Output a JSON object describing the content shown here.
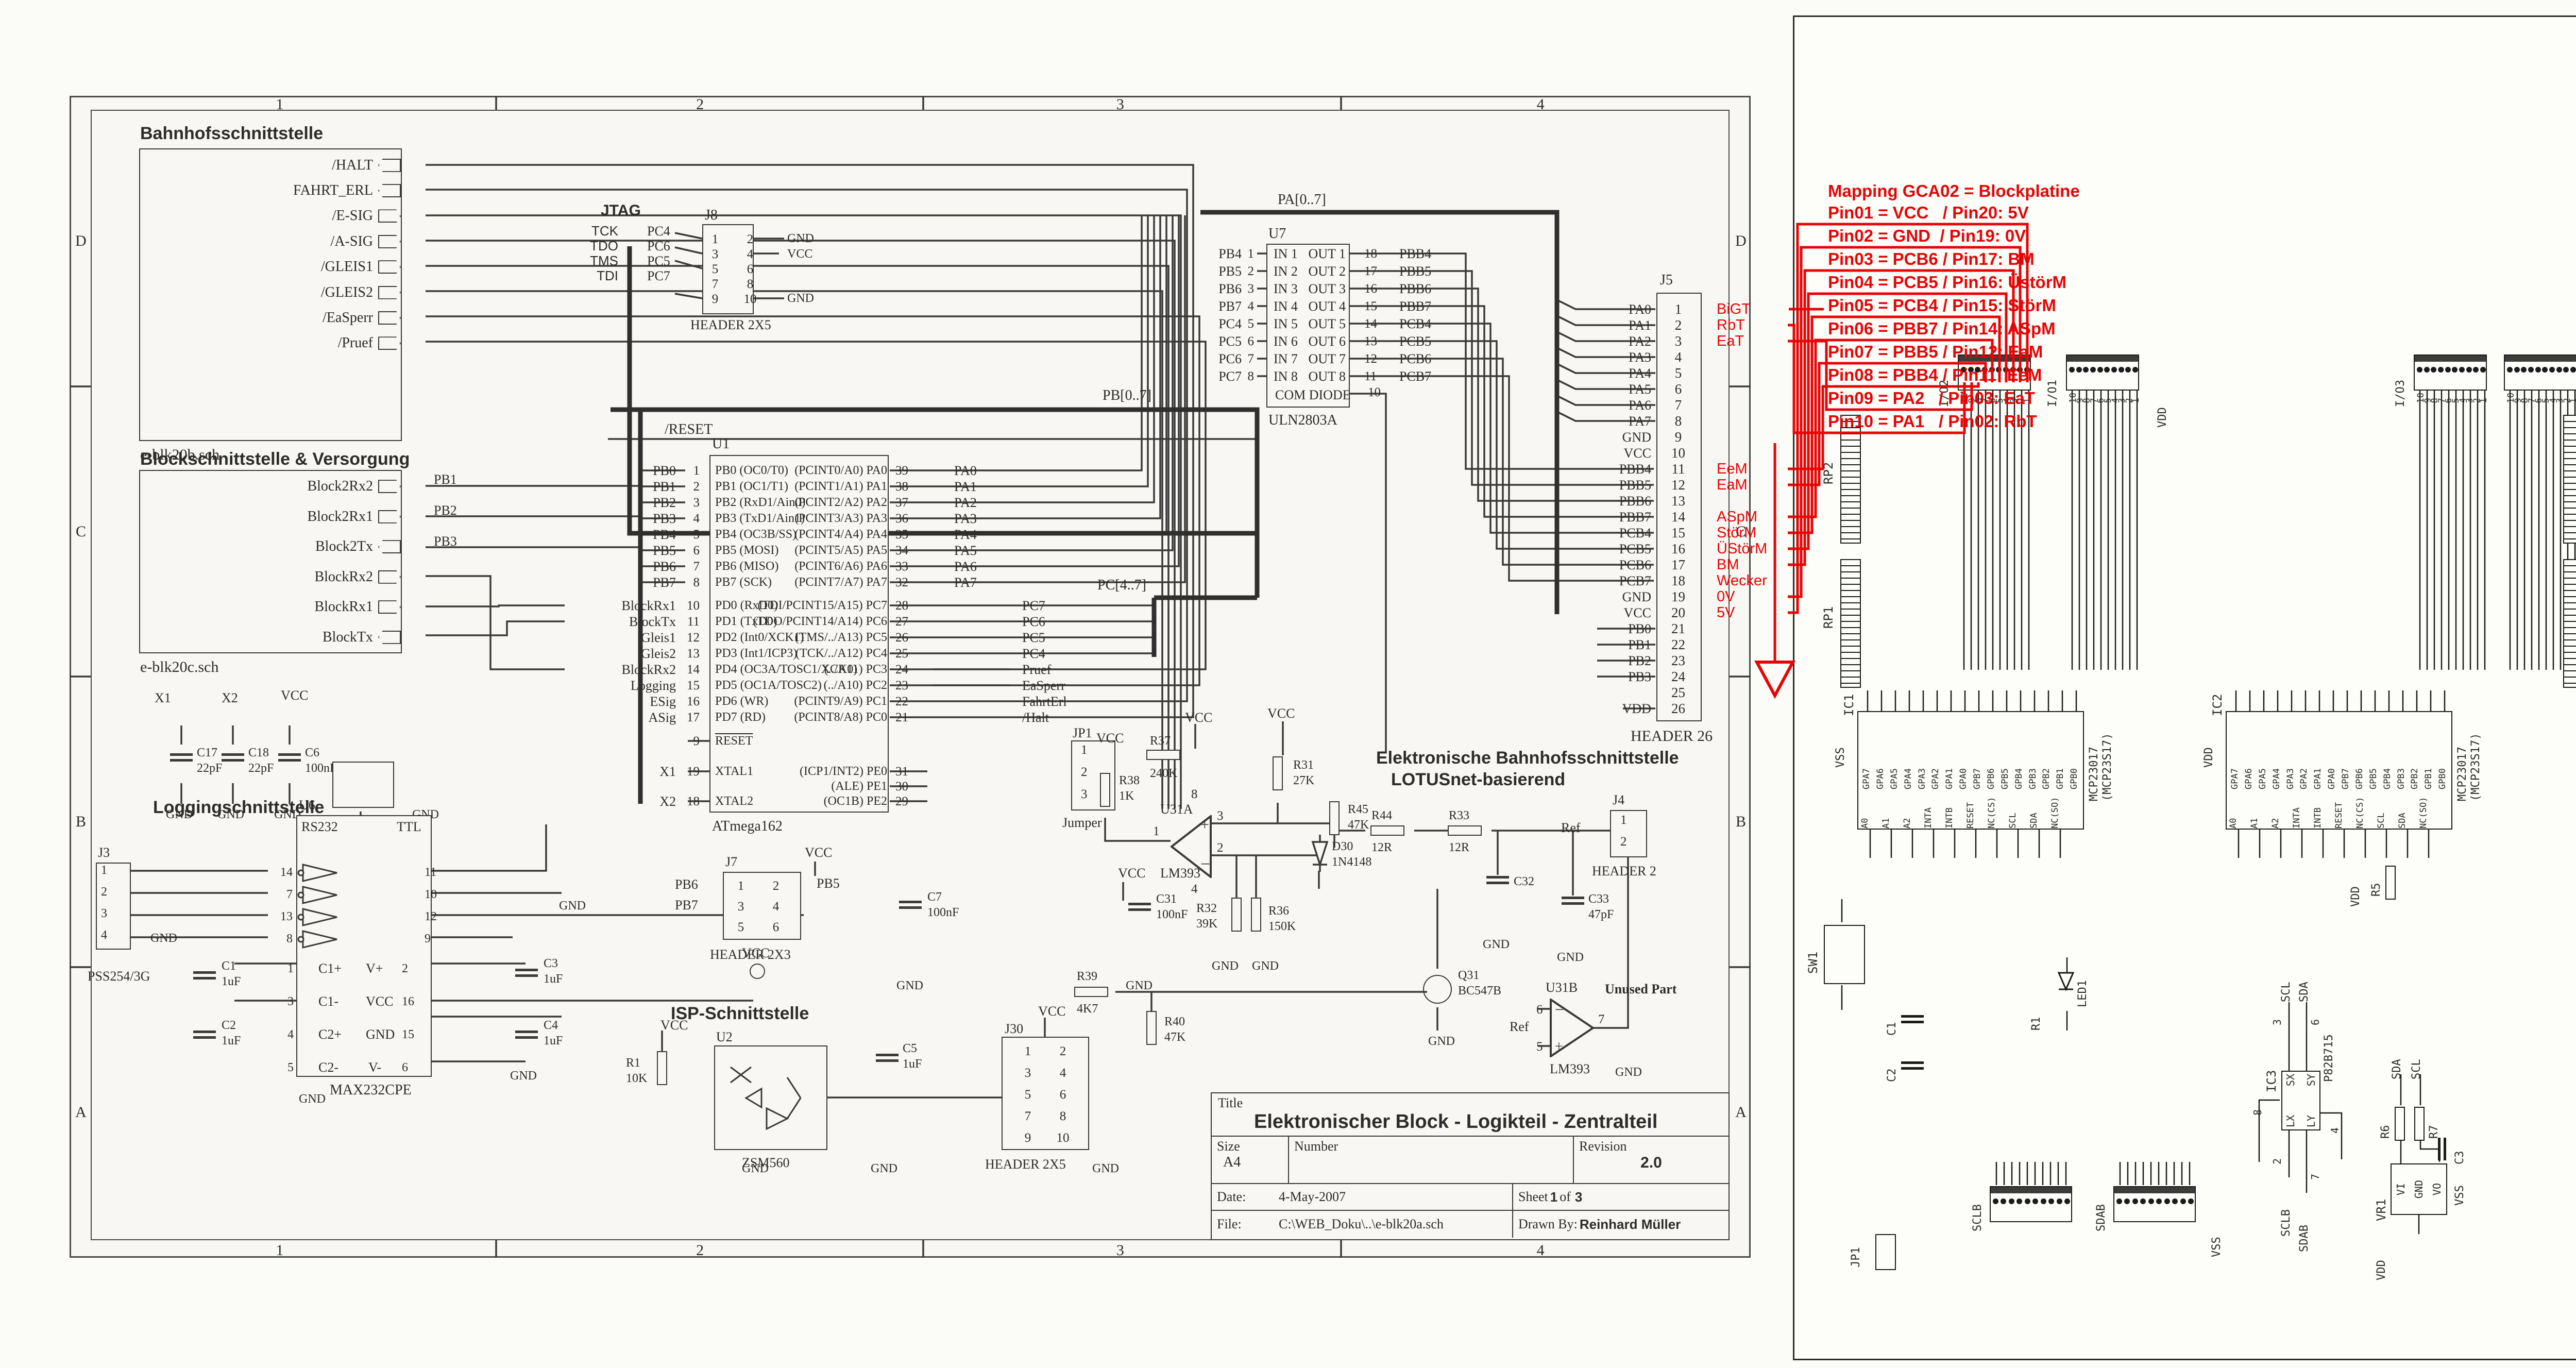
{
  "nets": {
    "gnd": "GND",
    "vcc": "VCC",
    "vdd": "VDD",
    "vss": "VSS",
    "sda": "SDA",
    "scl": "SCL",
    "sclb": "SCLB",
    "sdab": "SDAB",
    "reset": "/RESET",
    "pa_bus": "PA[0..7]",
    "pb_bus": "PB[0..7]",
    "pc_bus": "PC[4..7]",
    "x1": "X1",
    "x2": "X2",
    "ref": "Ref"
  },
  "left": {
    "ruler": {
      "cols": [
        "1",
        "2",
        "3",
        "4"
      ],
      "rows": [
        "D",
        "C",
        "B",
        "A"
      ]
    },
    "bahnhof": {
      "title": "Bahnhofsschnittstelle",
      "file": "e-blk20b.sch",
      "pins": [
        {
          "label": "/HALT",
          "dir": "in"
        },
        {
          "label": "FAHRT_ERL",
          "dir": "in"
        },
        {
          "label": "/E-SIG",
          "dir": "out"
        },
        {
          "label": "/A-SIG",
          "dir": "out"
        },
        {
          "label": "/GLEIS1",
          "dir": "out"
        },
        {
          "label": "/GLEIS2",
          "dir": "out"
        },
        {
          "label": "/EaSperr",
          "dir": "out"
        },
        {
          "label": "/Pruef",
          "dir": "out"
        }
      ]
    },
    "block2": {
      "title": "Blockschnittstelle & Versorgung",
      "file": "e-blk20c.sch",
      "pins": [
        {
          "label": "Block2Rx2",
          "dir": "out"
        },
        {
          "label": "Block2Rx1",
          "dir": "out"
        },
        {
          "label": "Block2Tx",
          "dir": "in"
        },
        {
          "label": "BlockRx2",
          "dir": "out"
        },
        {
          "label": "BlockRx1",
          "dir": "out"
        },
        {
          "label": "BlockTx",
          "dir": "in"
        }
      ],
      "right_nets": [
        "PB1",
        "PB2",
        "PB3"
      ]
    },
    "jtag": {
      "title": "JTAG",
      "rows": [
        {
          "sig": "TCK",
          "net": "PC4"
        },
        {
          "sig": "TDO",
          "net": "PC6"
        },
        {
          "sig": "TMS",
          "net": "PC5"
        },
        {
          "sig": "TDI",
          "net": "PC7"
        }
      ],
      "ref": "J8",
      "part": "HEADER 2X5",
      "pins": [
        {
          "l": "1",
          "r": "2"
        },
        {
          "l": "3",
          "r": "4"
        },
        {
          "l": "5",
          "r": "6"
        },
        {
          "l": "7",
          "r": "8"
        },
        {
          "l": "9",
          "r": "10"
        }
      ]
    },
    "u1": {
      "ref": "U1",
      "part": "ATmega162",
      "left_pb": [
        {
          "sig": "PB0",
          "pin": "1",
          "fn": "PB0 (OC0/T0)"
        },
        {
          "sig": "PB1",
          "pin": "2",
          "fn": "PB1 (OC1/T1)"
        },
        {
          "sig": "PB2",
          "pin": "3",
          "fn": "PB2 (RxD1/Ain0)"
        },
        {
          "sig": "PB3",
          "pin": "4",
          "fn": "PB3 (TxD1/Ain1)"
        },
        {
          "sig": "PB4",
          "pin": "5",
          "fn": "PB4 (OC3B/SS)"
        },
        {
          "sig": "PB5",
          "pin": "6",
          "fn": "PB5 (MOSI)"
        },
        {
          "sig": "PB6",
          "pin": "7",
          "fn": "PB6 (MISO)"
        },
        {
          "sig": "PB7",
          "pin": "8",
          "fn": "PB7 (SCK)"
        }
      ],
      "left_pd": [
        {
          "sig": "BlockRx1",
          "pin": "10",
          "fn": "PD0 (RxD0)"
        },
        {
          "sig": "BlockTx",
          "pin": "11",
          "fn": "PD1 (TxD0)"
        },
        {
          "sig": "Gleis1",
          "pin": "12",
          "fn": "PD2 (Int0/XCK1)"
        },
        {
          "sig": "Gleis2",
          "pin": "13",
          "fn": "PD3 (Int1/ICP3)"
        },
        {
          "sig": "BlockRx2",
          "pin": "14",
          "fn": "PD4 (OC3A/TOSC1/XCK0)"
        },
        {
          "sig": "Logging",
          "pin": "15",
          "fn": "PD5 (OC1A/TOSC2)"
        },
        {
          "sig": "ESig",
          "pin": "16",
          "fn": "PD6 (WR)"
        },
        {
          "sig": "ASig",
          "pin": "17",
          "fn": "PD7 (RD)"
        }
      ],
      "left_misc": [
        {
          "sig": "",
          "pin": "9",
          "fn": "RESET"
        },
        {
          "sig": "X1",
          "pin": "19",
          "fn": "XTAL1"
        },
        {
          "sig": "X2",
          "pin": "18",
          "fn": "XTAL2"
        }
      ],
      "right_pa": [
        {
          "fn": "(PCINT0/A0) PA0",
          "pin": "39",
          "sig": "PA0"
        },
        {
          "fn": "(PCINT1/A1) PA1",
          "pin": "38",
          "sig": "PA1"
        },
        {
          "fn": "(PCINT2/A2) PA2",
          "pin": "37",
          "sig": "PA2"
        },
        {
          "fn": "(PCINT3/A3) PA3",
          "pin": "36",
          "sig": "PA3"
        },
        {
          "fn": "(PCINT4/A4) PA4",
          "pin": "35",
          "sig": "PA4"
        },
        {
          "fn": "(PCINT5/A5) PA5",
          "pin": "34",
          "sig": "PA5"
        },
        {
          "fn": "(PCINT6/A6) PA6",
          "pin": "33",
          "sig": "PA6"
        },
        {
          "fn": "(PCINT7/A7) PA7",
          "pin": "32",
          "sig": "PA7"
        }
      ],
      "right_pc": [
        {
          "fn": "(TDI/PCINT15/A15) PC7",
          "pin": "28",
          "sig": "PC7"
        },
        {
          "fn": "(TDO/PCINT14/A14) PC6",
          "pin": "27",
          "sig": "PC6"
        },
        {
          "fn": "(TMS/../A13) PC5",
          "pin": "26",
          "sig": "PC5"
        },
        {
          "fn": "(TCK/../A12) PC4",
          "pin": "25",
          "sig": "PC4"
        },
        {
          "fn": "(../A11) PC3",
          "pin": "24",
          "sig": "Pruef"
        },
        {
          "fn": "(../A10) PC2",
          "pin": "23",
          "sig": "EaSperr"
        },
        {
          "fn": "(PCINT9/A9) PC1",
          "pin": "22",
          "sig": "FahrtErl"
        },
        {
          "fn": "(PCINT8/A8) PC0",
          "pin": "21",
          "sig": "/Halt"
        }
      ],
      "right_pe": [
        {
          "fn": "(ICP1/INT2) PE0",
          "pin": "31",
          "sig": ""
        },
        {
          "fn": "(ALE) PE1",
          "pin": "30",
          "sig": ""
        },
        {
          "fn": "(OC1B) PE2",
          "pin": "29",
          "sig": ""
        }
      ]
    },
    "u7": {
      "ref": "U7",
      "part": "ULN2803A",
      "com": "COM DIODE",
      "com_pin": "10",
      "left": [
        {
          "sig": "PB4",
          "pin": "1",
          "fn": "IN 1"
        },
        {
          "sig": "PB5",
          "pin": "2",
          "fn": "IN 2"
        },
        {
          "sig": "PB6",
          "pin": "3",
          "fn": "IN 3"
        },
        {
          "sig": "PB7",
          "pin": "4",
          "fn": "IN 4"
        },
        {
          "sig": "PC4",
          "pin": "5",
          "fn": "IN 5"
        },
        {
          "sig": "PC5",
          "pin": "6",
          "fn": "IN 6"
        },
        {
          "sig": "PC6",
          "pin": "7",
          "fn": "IN 7"
        },
        {
          "sig": "PC7",
          "pin": "8",
          "fn": "IN 8"
        }
      ],
      "right": [
        {
          "fn": "OUT 1",
          "pin": "18",
          "sig": "PBB4"
        },
        {
          "fn": "OUT 2",
          "pin": "17",
          "sig": "PBB5"
        },
        {
          "fn": "OUT 3",
          "pin": "16",
          "sig": "PBB6"
        },
        {
          "fn": "OUT 4",
          "pin": "15",
          "sig": "PBB7"
        },
        {
          "fn": "OUT 5",
          "pin": "14",
          "sig": "PCB4"
        },
        {
          "fn": "OUT 6",
          "pin": "13",
          "sig": "PCB5"
        },
        {
          "fn": "OUT 7",
          "pin": "12",
          "sig": "PCB6"
        },
        {
          "fn": "OUT 8",
          "pin": "11",
          "sig": "PCB7"
        }
      ]
    },
    "j5": {
      "ref": "J5",
      "part": "HEADER 26",
      "pins": [
        {
          "n": "1",
          "sig": "PA0",
          "red": "BiGT"
        },
        {
          "n": "2",
          "sig": "PA1",
          "red": "RbT"
        },
        {
          "n": "3",
          "sig": "PA2",
          "red": "EaT"
        },
        {
          "n": "4",
          "sig": "PA3",
          "red": ""
        },
        {
          "n": "5",
          "sig": "PA4",
          "red": ""
        },
        {
          "n": "6",
          "sig": "PA5",
          "red": ""
        },
        {
          "n": "7",
          "sig": "PA6",
          "red": ""
        },
        {
          "n": "8",
          "sig": "PA7",
          "red": ""
        },
        {
          "n": "9",
          "sig": "GND",
          "red": ""
        },
        {
          "n": "10",
          "sig": "VCC",
          "red": ""
        },
        {
          "n": "11",
          "sig": "PBB4",
          "red": "EeM"
        },
        {
          "n": "12",
          "sig": "PBB5",
          "red": "EaM"
        },
        {
          "n": "13",
          "sig": "PBB6",
          "red": ""
        },
        {
          "n": "14",
          "sig": "PBB7",
          "red": "ASpM"
        },
        {
          "n": "15",
          "sig": "PCB4",
          "red": "StörM"
        },
        {
          "n": "16",
          "sig": "PCB5",
          "red": "ÜStörM"
        },
        {
          "n": "17",
          "sig": "PCB6",
          "red": "BM"
        },
        {
          "n": "18",
          "sig": "PCB7",
          "red": "Wecker"
        },
        {
          "n": "19",
          "sig": "GND",
          "red": "0V"
        },
        {
          "n": "20",
          "sig": "VCC",
          "red": "5V"
        },
        {
          "n": "21",
          "sig": "PB0",
          "red": ""
        },
        {
          "n": "22",
          "sig": "PB1",
          "red": ""
        },
        {
          "n": "23",
          "sig": "PB2",
          "red": ""
        },
        {
          "n": "24",
          "sig": "PB3",
          "red": ""
        },
        {
          "n": "25",
          "sig": "",
          "red": ""
        },
        {
          "n": "26",
          "sig": "VDD",
          "red": ""
        }
      ]
    },
    "mapping": {
      "title": "Mapping GCA02 = Blockplatine",
      "lines": [
        "Pin01 = VCC   / Pin20: 5V",
        "Pin02 = GND  / Pin19: 0V",
        "Pin03 = PCB6 / Pin17: BM",
        "Pin04 = PCB5 / Pin16: ÜstörM",
        "Pin05 = PCB4 / Pin15: StörM",
        "Pin06 = PBB7 / Pin14: ASpM",
        "Pin07 = PBB5 / Pin12: EaM",
        "Pin08 = PBB4 / Pin11: EeM",
        "Pin09 = PA2   / Pin03: EaT",
        "Pin10 = PA1   / Pin02: RbT"
      ]
    },
    "xtal": {
      "c17": {
        "r": "C17",
        "v": "22pF"
      },
      "c18": {
        "r": "C18",
        "v": "22pF"
      },
      "c6": {
        "r": "C6",
        "v": "100nF"
      },
      "crystal": {
        "r": "X1",
        "p": "CST8.00MTW"
      }
    },
    "logging": {
      "title": "Loggingschnittstelle",
      "j3": {
        "ref": "J3",
        "part": "PSS254/3G",
        "pins": [
          "1",
          "2",
          "3",
          "4"
        ]
      },
      "u6": {
        "ref": "U6",
        "l": "RS232",
        "r": "TTL",
        "part": "MAX232CPE",
        "inv": [
          {
            "l": "14",
            "r": "11"
          },
          {
            "l": "7",
            "r": "10"
          },
          {
            "l": "13",
            "r": "12"
          },
          {
            "l": "8",
            "r": "9"
          }
        ],
        "rows": [
          {
            "pl": "1",
            "nl": "C1+",
            "nr": "V+",
            "pr": "2"
          },
          {
            "pl": "3",
            "nl": "C1-",
            "nr": "VCC",
            "pr": "16"
          },
          {
            "pl": "4",
            "nl": "C2+",
            "nr": "GND",
            "pr": "15"
          },
          {
            "pl": "5",
            "nl": "C2-",
            "nr": "V-",
            "pr": "6"
          }
        ]
      },
      "c1": {
        "r": "C1",
        "v": "1uF"
      },
      "c2": {
        "r": "C2",
        "v": "1uF"
      },
      "c3": {
        "r": "C3",
        "v": "1uF"
      },
      "c4": {
        "r": "C4",
        "v": "1uF"
      }
    },
    "isp": {
      "title": "ISP-Schnittstelle",
      "r1": {
        "r": "R1",
        "v": "10K"
      },
      "u2": {
        "ref": "U2",
        "part": "ZSM560"
      },
      "j30": {
        "ref": "J30",
        "part": "HEADER 2X5",
        "pins": [
          {
            "l": "1",
            "r": "2"
          },
          {
            "l": "3",
            "r": "4"
          },
          {
            "l": "5",
            "r": "6"
          },
          {
            "l": "7",
            "r": "8"
          },
          {
            "l": "9",
            "r": "10"
          }
        ]
      },
      "c5": {
        "r": "C5",
        "v": "1uF"
      }
    },
    "analog": {
      "title": "Elektronische Bahnhofsschnittstelle",
      "subtitle": "LOTUSnet-basierend",
      "jp1": {
        "ref": "JP1",
        "part": "Jumper",
        "pins": [
          "1",
          "2",
          "3"
        ]
      },
      "r37": {
        "r": "R37",
        "v": "240K"
      },
      "r38": {
        "r": "R38",
        "v": "1K"
      },
      "r31": {
        "r": "R31",
        "v": "27K"
      },
      "r45": {
        "r": "R45",
        "v": "47K"
      },
      "r44": {
        "r": "R44",
        "v": "12R"
      },
      "r33": {
        "r": "R33",
        "v": "12R"
      },
      "r32": {
        "r": "R32",
        "v": "39K"
      },
      "r36": {
        "r": "R36",
        "v": "150K"
      },
      "r39": {
        "r": "R39",
        "v": "4K7"
      },
      "r40": {
        "r": "R40",
        "v": "47K"
      },
      "c7": {
        "r": "C7",
        "v": "100nF"
      },
      "c31": {
        "r": "C31",
        "v": "100nF"
      },
      "c32": {
        "r": "C32",
        "v": ""
      },
      "c33": {
        "r": "C33",
        "v": "47pF"
      },
      "d30": {
        "r": "D30",
        "p": "1N4148"
      },
      "q31": {
        "r": "Q31",
        "p": "BC547B"
      },
      "u31a": {
        "ref": "U31A",
        "part": "LM393"
      },
      "u31b": {
        "ref": "U31B",
        "part": "LM393",
        "note": "Unused Part"
      },
      "j4": {
        "ref": "J4",
        "part": "HEADER 2",
        "pins": [
          "1",
          "2"
        ]
      },
      "j7": {
        "ref": "J7",
        "part": "HEADER 2X3",
        "pins": [
          {
            "l": "1",
            "r": "2"
          },
          {
            "l": "3",
            "r": "4"
          },
          {
            "l": "5",
            "r": "6"
          }
        ],
        "lnets": [
          "PB6",
          "PB7"
        ],
        "rnet": "PB5"
      }
    },
    "titleblock": {
      "title_label": "Title",
      "title": "Elektronischer Block - Logikteil - Zentralteil",
      "size_label": "Size",
      "size": "A4",
      "number_label": "Number",
      "number": "",
      "revision_label": "Revision",
      "revision": "2.0",
      "date_label": "Date:",
      "date": "4-May-2007",
      "sheet_label": "Sheet",
      "sheet_no": "1",
      "of_label": "of",
      "sheet_total": "3",
      "file_label": "File:",
      "file": "C:\\WEB_Doku\\..\\e-blk20a.sch",
      "drawn_label": "Drawn By:",
      "drawn": "Reinhard Müller"
    }
  },
  "right": {
    "tb": {
      "company": "Giling Computer Applications",
      "url1": "www.phgiling.net",
      "url2": "www.rocrail.net",
      "title_label": "Title",
      "title": "32 ports I/O board for Raspberry Pi",
      "size_label": "Size",
      "size": "B",
      "doc_label": "Document Number",
      "doc": "GCA_PIO2",
      "rev_label": "REV",
      "rev": "1.0",
      "date_label": "Date:",
      "date": "November 22, 2013",
      "sheet_label": "Sheet",
      "of_label": "of"
    },
    "conns": [
      {
        "ref": "I/O2"
      },
      {
        "ref": "I/O1"
      },
      {
        "ref": "I/O3"
      },
      {
        "ref": "I/O4"
      }
    ],
    "conn_pins": [
      "10",
      "9",
      "8",
      "7",
      "6",
      "5",
      "4",
      "3",
      "2",
      "1"
    ],
    "bot_conns": [
      {
        "ref": "SCLB"
      },
      {
        "ref": "SDAB"
      }
    ],
    "rps": [
      "RP2",
      "RP1",
      "RP4",
      "RP3"
    ],
    "ic1": "IC1",
    "ic2": "IC2",
    "mcp": {
      "part": "MCP23017",
      "alt": "(MCP23S17)",
      "top": [
        {
          "n": "28",
          "l": "GPA7"
        },
        {
          "n": "27",
          "l": "GPA6"
        },
        {
          "n": "26",
          "l": "GPA5"
        },
        {
          "n": "25",
          "l": "GPA4"
        },
        {
          "n": "24",
          "l": "GPA3"
        },
        {
          "n": "23",
          "l": "GPA2"
        },
        {
          "n": "22",
          "l": "GPA1"
        },
        {
          "n": "21",
          "l": "GPA0"
        },
        {
          "n": "8",
          "l": "GPB7"
        },
        {
          "n": "7",
          "l": "GPB6"
        },
        {
          "n": "6",
          "l": "GPB5"
        },
        {
          "n": "5",
          "l": "GPB4"
        },
        {
          "n": "4",
          "l": "GPB3"
        },
        {
          "n": "3",
          "l": "GPB2"
        },
        {
          "n": "2",
          "l": "GPB1"
        },
        {
          "n": "1",
          "l": "GPB0"
        }
      ],
      "bottom": [
        {
          "n": "15",
          "l": "A0"
        },
        {
          "n": "16",
          "l": "A1"
        },
        {
          "n": "17",
          "l": "A2"
        },
        {
          "n": "20",
          "l": "INTA"
        },
        {
          "n": "19",
          "l": "INTB"
        },
        {
          "n": "18",
          "l": "RESET"
        },
        {
          "n": "11",
          "l": "NC(CS)"
        },
        {
          "n": "12",
          "l": "SCL"
        },
        {
          "n": "13",
          "l": "SDA"
        },
        {
          "n": "14",
          "l": "NC(SO)"
        }
      ],
      "vdd_pin": "9",
      "vss_pin": "10"
    },
    "ic3": {
      "ref": "IC3",
      "part": "P82B715",
      "sx": "SX",
      "sy": "SY",
      "lx": "LX",
      "ly": "LY",
      "plus": "+",
      "minus": "-",
      "p3": "3",
      "p6": "6",
      "p2": "2",
      "p7": "7",
      "p8": "8",
      "p4": "4"
    },
    "vr1": {
      "ref": "VR1",
      "vi": "VI",
      "vo": "VO",
      "gnd": "GND",
      "p1": "1",
      "p3": "3",
      "p2": "2"
    },
    "small": {
      "sw1": "SW1",
      "led1": "LED1",
      "c1": "C1",
      "c2": "C2",
      "c3": "C3",
      "r1": "R1",
      "r5": "R5",
      "r6": "R6",
      "r7": "R7",
      "jp1": "JP1"
    }
  }
}
